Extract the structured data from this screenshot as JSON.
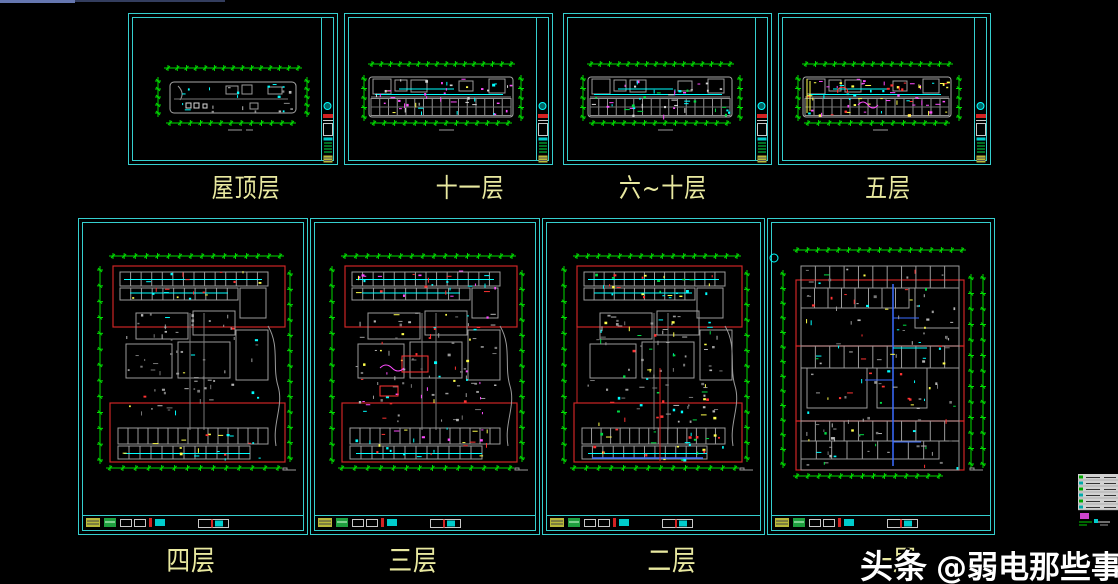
{
  "app": {
    "watermark_brand": "头条",
    "watermark_handle": "@弱电那些事"
  },
  "colors": {
    "background": "#000000",
    "sheet_border": "#35cfcf",
    "dim_green": "#00dc00",
    "plan_gray": "#9a9a9a",
    "plan_gray_dim": "#6e6e6e",
    "plan_white": "#d8d8d8",
    "highlight_red": "#cc2626",
    "title_red": "#d42222",
    "detail_cyan": "#00ffff",
    "detail_magenta": "#ff4cff",
    "detail_yellow": "#ffff4c",
    "detail_green": "#00dd44",
    "detail_red": "#ff3333",
    "trunk_blue": "#3a6cff",
    "label_khaki": "#e9e9a0",
    "watermark_white": "#ffffff",
    "window_edge_blue": "#6677b0",
    "window_edge_dim": "#333d5e"
  },
  "sheets": [
    {
      "id": "roof",
      "label": "屋顶层",
      "variant": "landscape-roof",
      "x": 128,
      "y": 13,
      "w": 210,
      "h": 152,
      "label_cx": 246,
      "label_y": 176,
      "accents": [
        "#00ffff",
        "#b8b8b8"
      ]
    },
    {
      "id": "floor-11",
      "label": "十一层",
      "variant": "landscape-strip",
      "x": 344,
      "y": 13,
      "w": 209,
      "h": 152,
      "label_cx": 470,
      "label_y": 176,
      "accents": [
        "#00ffff",
        "#ffff4c",
        "#ff4cff",
        "#d8d8d8"
      ]
    },
    {
      "id": "floor-6-10",
      "label": "六~十层",
      "variant": "landscape-strip",
      "x": 563,
      "y": 13,
      "w": 209,
      "h": 152,
      "label_cx": 663,
      "label_y": 176,
      "accents": [
        "#00ffff",
        "#00dd44",
        "#ff4cff",
        "#d8d8d8"
      ]
    },
    {
      "id": "floor-5",
      "label": "五层",
      "variant": "landscape-strip-busy",
      "x": 778,
      "y": 13,
      "w": 213,
      "h": 152,
      "label_cx": 888,
      "label_y": 176,
      "accents": [
        "#ff3333",
        "#ff4cff",
        "#00ffff",
        "#ffff4c"
      ]
    },
    {
      "id": "floor-4",
      "label": "四层",
      "variant": "portrait-plain",
      "x": 78,
      "y": 218,
      "w": 230,
      "h": 317,
      "label_cx": 191,
      "label_y": 546,
      "accents": [
        "#00ffff",
        "#ffff4c",
        "#ff3333"
      ]
    },
    {
      "id": "floor-3",
      "label": "三层",
      "variant": "portrait-busy",
      "x": 310,
      "y": 218,
      "w": 230,
      "h": 317,
      "label_cx": 413,
      "label_y": 546,
      "accents": [
        "#00ffff",
        "#ff3333",
        "#ffff4c",
        "#ff4cff"
      ]
    },
    {
      "id": "floor-2",
      "label": "二层",
      "variant": "portrait-busy2",
      "x": 542,
      "y": 218,
      "w": 223,
      "h": 317,
      "label_cx": 672,
      "label_y": 546,
      "accents": [
        "#00ffff",
        "#ff3333",
        "#ffff4c",
        "#00dd44"
      ]
    },
    {
      "id": "floor-1",
      "label": "一层",
      "variant": "portrait-grid",
      "x": 767,
      "y": 218,
      "w": 228,
      "h": 317,
      "label_cx": 893,
      "label_y": 546,
      "accents": [
        "#00ffff",
        "#ffff4c",
        "#00dd44",
        "#ff3333"
      ]
    }
  ]
}
